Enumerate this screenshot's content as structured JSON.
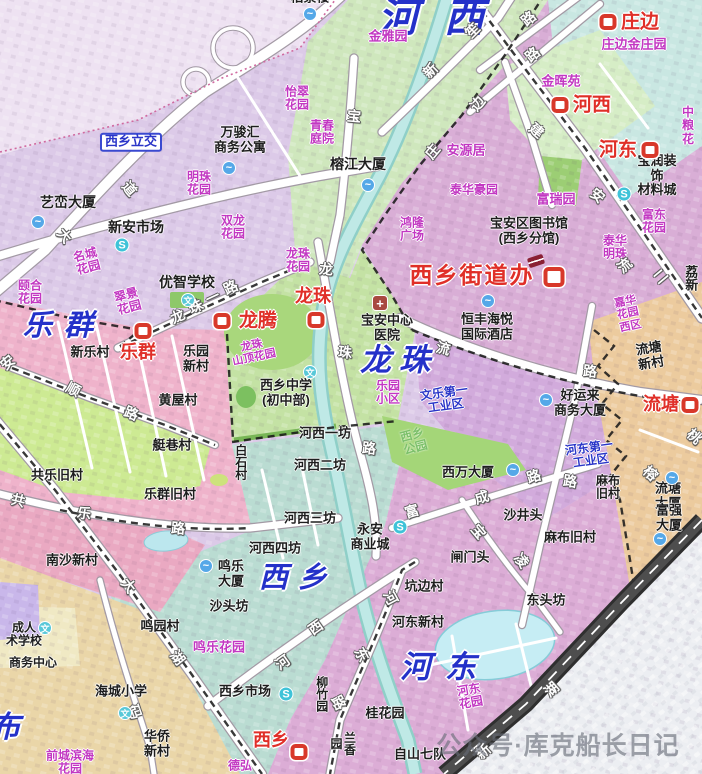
{
  "watermark": {
    "text": "公众号·库克船长日记"
  },
  "colors": {
    "district_label_blue": "#2431c9",
    "station_red": "#d8382a",
    "garden_magenta": "#c238c2",
    "industrial_blue": "#2a35c8",
    "river_teal": "#bfe9e6",
    "region_lavender": "#dccae8",
    "region_green_hexi": "#cfe7bd",
    "region_plum_hedong": "#d9aed6",
    "region_cyan_zhuangbian": "#c9e7e2",
    "region_pink_lequn": "#efb3cb",
    "region_green_longzhu": "#c4e2a4",
    "region_teal_xixiang": "#badcd2",
    "region_orchid_hedong_s": "#dcadd6",
    "region_tan_liutang": "#eccb9e",
    "highway_dark": "#2f2f2f"
  },
  "icon_glyphs": {
    "station": "",
    "water": "~",
    "market": "S",
    "school": "文",
    "hospital": "+",
    "book": ""
  },
  "labels": [
    {
      "t": "河西",
      "x": 444,
      "y": 19,
      "cls": "dist",
      "fs": 40,
      "ls": 26,
      "n": "district-hexi"
    },
    {
      "t": "乐群",
      "x": 64,
      "y": 326,
      "cls": "dist",
      "fs": 29,
      "ls": 12,
      "n": "district-lequn"
    },
    {
      "t": "龙珠",
      "x": 399,
      "y": 361,
      "cls": "dist",
      "fs": 31,
      "ls": 8,
      "n": "district-longzhu"
    },
    {
      "t": "西乡",
      "x": 298,
      "y": 578,
      "cls": "dist",
      "fs": 29,
      "ls": 10,
      "n": "district-xixiang"
    },
    {
      "t": "河东",
      "x": 445,
      "y": 668,
      "cls": "dist",
      "fs": 31,
      "ls": 14,
      "n": "district-hedong"
    },
    {
      "t": "布",
      "x": 5,
      "y": 728,
      "cls": "dist",
      "fs": 30,
      "n": "district-bu-partial"
    },
    {
      "t": "西乡街道办",
      "x": 472,
      "y": 276,
      "cls": "red",
      "fs": 23,
      "ls": 2,
      "n": "label-xixiang-jiedaoban"
    },
    {
      "t": "庄边",
      "x": 640,
      "y": 22,
      "cls": "red",
      "fs": 19
    },
    {
      "t": "河西",
      "x": 592,
      "y": 105,
      "cls": "red",
      "fs": 19
    },
    {
      "t": "河东",
      "x": 618,
      "y": 150,
      "cls": "red",
      "fs": 19
    },
    {
      "t": "龙腾",
      "x": 258,
      "y": 321,
      "cls": "red",
      "fs": 19
    },
    {
      "t": "乐群",
      "x": 138,
      "y": 352,
      "cls": "red"
    },
    {
      "t": "龙珠",
      "x": 313,
      "y": 296,
      "cls": "red"
    },
    {
      "t": "流塘",
      "x": 661,
      "y": 404,
      "cls": "red"
    },
    {
      "t": "西乡",
      "x": 271,
      "y": 740,
      "cls": "red"
    },
    {
      "t": "西乡立交",
      "x": 131,
      "y": 142,
      "cls": "box",
      "n": "label-xixiang-interchange"
    },
    {
      "t": "怡翠\n花园",
      "x": 297,
      "y": 99,
      "cls": "mag"
    },
    {
      "t": "青春\n庭院",
      "x": 322,
      "y": 133,
      "cls": "mag"
    },
    {
      "t": "金雅园",
      "x": 388,
      "y": 37,
      "cls": "mag",
      "fs": 13
    },
    {
      "t": "明珠\n花园",
      "x": 199,
      "y": 184,
      "cls": "mag"
    },
    {
      "t": "双龙\n花园",
      "x": 233,
      "y": 228,
      "cls": "mag"
    },
    {
      "t": "名城\n花园",
      "x": 87,
      "y": 262,
      "cls": "mag",
      "rot": -15
    },
    {
      "t": "翠景\n花园",
      "x": 128,
      "y": 302,
      "cls": "mag",
      "rot": -15
    },
    {
      "t": "颐合\n花园",
      "x": 30,
      "y": 293,
      "cls": "mag"
    },
    {
      "t": "庄边金庄园",
      "x": 634,
      "y": 45,
      "cls": "mag",
      "fs": 13
    },
    {
      "t": "金晖苑",
      "x": 561,
      "y": 82,
      "cls": "mag",
      "fs": 13
    },
    {
      "t": "安源居",
      "x": 466,
      "y": 151,
      "cls": "mag",
      "fs": 13
    },
    {
      "t": "泰华豪园",
      "x": 474,
      "y": 190,
      "cls": "mag"
    },
    {
      "t": "富瑞园",
      "x": 556,
      "y": 200,
      "cls": "mag",
      "fs": 13
    },
    {
      "t": "富东\n花园",
      "x": 654,
      "y": 222,
      "cls": "mag"
    },
    {
      "t": "泰华\n明珠",
      "x": 615,
      "y": 248,
      "cls": "mag"
    },
    {
      "t": "鸿隆\n广场",
      "x": 412,
      "y": 230,
      "cls": "mag"
    },
    {
      "t": "龙珠\n花园",
      "x": 298,
      "y": 261,
      "cls": "mag"
    },
    {
      "t": "龙珠\n山顶花园",
      "x": 253,
      "y": 352,
      "cls": "mag",
      "rot": -12,
      "fs": 11
    },
    {
      "t": "乐园\n小区",
      "x": 388,
      "y": 393,
      "cls": "mag"
    },
    {
      "t": "嘉华\n花园\n西区",
      "x": 628,
      "y": 314,
      "cls": "mag",
      "rot": -12,
      "fs": 11
    },
    {
      "t": "河东\n花园",
      "x": 470,
      "y": 697,
      "cls": "mag",
      "rot": -10
    },
    {
      "t": "鸣乐花园",
      "x": 219,
      "y": 648,
      "cls": "mag",
      "fs": 13
    },
    {
      "t": "前城滨海\n花园",
      "x": 70,
      "y": 763,
      "cls": "mag"
    },
    {
      "t": "德弘",
      "x": 240,
      "y": 766,
      "cls": "mag"
    },
    {
      "t": "中粮\n花",
      "x": 688,
      "y": 126,
      "cls": "mag"
    },
    {
      "t": "文乐第一\n工业区",
      "x": 445,
      "y": 400,
      "cls": "blu",
      "rot": -8
    },
    {
      "t": "河东第一\n工业区",
      "x": 590,
      "y": 455,
      "cls": "blu",
      "rot": -8
    },
    {
      "t": "西乡\n公园",
      "x": 414,
      "y": 442,
      "cls": "grn",
      "rot": -15
    },
    {
      "t": "柏景楼",
      "x": 310,
      "y": -2,
      "cls": "blk"
    },
    {
      "t": "万骏汇\n商务公寓",
      "x": 240,
      "y": 140,
      "cls": "blk"
    },
    {
      "t": "艺峦大厦",
      "x": 68,
      "y": 203,
      "cls": "blk",
      "fs": 14
    },
    {
      "t": "新安市场",
      "x": 136,
      "y": 228,
      "cls": "blk",
      "fs": 14
    },
    {
      "t": "榕江大厦",
      "x": 358,
      "y": 165,
      "cls": "blk",
      "fs": 14
    },
    {
      "t": "优智学校",
      "x": 187,
      "y": 283,
      "cls": "blk",
      "fs": 14
    },
    {
      "t": "宝安区图书馆\n(西乡分馆)",
      "x": 529,
      "y": 231,
      "cls": "blk"
    },
    {
      "t": "宝润装饰\n材料城",
      "x": 657,
      "y": 176,
      "cls": "blk"
    },
    {
      "t": "恒丰海悦\n国际酒店",
      "x": 487,
      "y": 327,
      "cls": "blk"
    },
    {
      "t": "宝安中心\n医院",
      "x": 387,
      "y": 328,
      "cls": "blk"
    },
    {
      "t": "西乡中学\n(初中部)",
      "x": 286,
      "y": 393,
      "cls": "blk"
    },
    {
      "t": "新乐村",
      "x": 90,
      "y": 353,
      "cls": "blk"
    },
    {
      "t": "乐园\n新村",
      "x": 196,
      "y": 359,
      "cls": "blk"
    },
    {
      "t": "黄屋村",
      "x": 178,
      "y": 401,
      "cls": "blk"
    },
    {
      "t": "艇巷村",
      "x": 172,
      "y": 446,
      "cls": "blk"
    },
    {
      "t": "乐群旧村",
      "x": 170,
      "y": 495,
      "cls": "blk"
    },
    {
      "t": "共乐旧村",
      "x": 57,
      "y": 476,
      "cls": "blk"
    },
    {
      "t": "南沙新村",
      "x": 72,
      "y": 561,
      "cls": "blk"
    },
    {
      "t": "白石村",
      "x": 240,
      "y": 462,
      "cls": "blk",
      "vert": true,
      "fs": 12
    },
    {
      "t": "河西一坊",
      "x": 325,
      "y": 434,
      "cls": "blk"
    },
    {
      "t": "河西二坊",
      "x": 320,
      "y": 466,
      "cls": "blk"
    },
    {
      "t": "河西三坊",
      "x": 310,
      "y": 519,
      "cls": "blk"
    },
    {
      "t": "河西四坊",
      "x": 275,
      "y": 549,
      "cls": "blk"
    },
    {
      "t": "永安\n商业城",
      "x": 370,
      "y": 537,
      "cls": "blk"
    },
    {
      "t": "鸣乐\n大厦",
      "x": 231,
      "y": 574,
      "cls": "blk"
    },
    {
      "t": "沙头坊",
      "x": 229,
      "y": 607,
      "cls": "blk"
    },
    {
      "t": "鸣园村",
      "x": 160,
      "y": 627,
      "cls": "blk"
    },
    {
      "t": "西乡市场",
      "x": 245,
      "y": 692,
      "cls": "blk"
    },
    {
      "t": "柳竹园",
      "x": 321,
      "y": 694,
      "cls": "blk",
      "vert": true,
      "fs": 12
    },
    {
      "t": "兰香园",
      "x": 342,
      "y": 743,
      "cls": "blk",
      "vert": true,
      "fs": 12
    },
    {
      "t": "桂花园",
      "x": 385,
      "y": 714,
      "cls": "blk"
    },
    {
      "t": "自山七队",
      "x": 420,
      "y": 755,
      "cls": "blk"
    },
    {
      "t": "华侨\n新村",
      "x": 157,
      "y": 744,
      "cls": "blk"
    },
    {
      "t": "海城小学",
      "x": 121,
      "y": 692,
      "cls": "blk"
    },
    {
      "t": "商务中心",
      "x": 33,
      "y": 663,
      "cls": "blk",
      "fs": 12
    },
    {
      "t": "成人\n术学校",
      "x": 24,
      "y": 635,
      "cls": "blk",
      "fs": 12
    },
    {
      "t": "西万大厦",
      "x": 468,
      "y": 473,
      "cls": "blk"
    },
    {
      "t": "沙井头",
      "x": 523,
      "y": 516,
      "cls": "blk"
    },
    {
      "t": "闸门头",
      "x": 470,
      "y": 558,
      "cls": "blk"
    },
    {
      "t": "坑边村",
      "x": 424,
      "y": 587,
      "cls": "blk"
    },
    {
      "t": "东头坊",
      "x": 546,
      "y": 601,
      "cls": "blk"
    },
    {
      "t": "河东新村",
      "x": 418,
      "y": 623,
      "cls": "blk"
    },
    {
      "t": "麻布\n旧村",
      "x": 608,
      "y": 488,
      "cls": "blk",
      "fs": 12
    },
    {
      "t": "麻布旧村",
      "x": 570,
      "y": 538,
      "cls": "blk"
    },
    {
      "t": "流塘大厦",
      "x": 668,
      "y": 496,
      "cls": "blk"
    },
    {
      "t": "富强大厦",
      "x": 669,
      "y": 518,
      "cls": "blk"
    },
    {
      "t": "流塘\n新村",
      "x": 650,
      "y": 356,
      "cls": "blk",
      "rot": -10
    },
    {
      "t": "好运来\n商务大厦",
      "x": 580,
      "y": 403,
      "cls": "blk"
    },
    {
      "t": "荔新",
      "x": 690,
      "y": 278,
      "cls": "blk",
      "vert": true
    },
    {
      "t": "大",
      "x": 64,
      "y": 236,
      "cls": "road",
      "rot": 50
    },
    {
      "t": "道",
      "x": 129,
      "y": 189,
      "cls": "road",
      "rot": 50
    },
    {
      "t": "新",
      "x": 431,
      "y": 71,
      "cls": "road",
      "rot": -45
    },
    {
      "t": "笙",
      "x": 473,
      "y": 31,
      "cls": "road",
      "rot": -45
    },
    {
      "t": "路",
      "x": 529,
      "y": 19,
      "cls": "road",
      "rot": -40
    },
    {
      "t": "路",
      "x": 533,
      "y": 55,
      "cls": "road",
      "rot": -40
    },
    {
      "t": "宝",
      "x": 354,
      "y": 117,
      "cls": "road",
      "rot": 5
    },
    {
      "t": "庄",
      "x": 433,
      "y": 152,
      "cls": "road",
      "rot": -50
    },
    {
      "t": "边",
      "x": 478,
      "y": 104,
      "cls": "road",
      "rot": -50
    },
    {
      "t": "建",
      "x": 536,
      "y": 131,
      "cls": "road",
      "rot": 40
    },
    {
      "t": "安",
      "x": 597,
      "y": 196,
      "cls": "road",
      "rot": 40
    },
    {
      "t": "流",
      "x": 443,
      "y": 349,
      "cls": "road",
      "rot": 15
    },
    {
      "t": "路",
      "x": 590,
      "y": 372,
      "cls": "road",
      "rot": 5
    },
    {
      "t": "路",
      "x": 570,
      "y": 482,
      "cls": "road",
      "rot": 8
    },
    {
      "t": "流",
      "x": 625,
      "y": 266,
      "cls": "road",
      "rot": -40
    },
    {
      "t": "二",
      "x": 661,
      "y": 277,
      "cls": "road",
      "rot": -40
    },
    {
      "t": "榕",
      "x": 650,
      "y": 474,
      "cls": "road",
      "rot": 42
    },
    {
      "t": "桃",
      "x": 694,
      "y": 437,
      "cls": "road",
      "rot": 42
    },
    {
      "t": "龙",
      "x": 326,
      "y": 270,
      "cls": "road",
      "rot": 5
    },
    {
      "t": "珠",
      "x": 345,
      "y": 353,
      "cls": "road",
      "rot": 5
    },
    {
      "t": "路",
      "x": 369,
      "y": 449,
      "cls": "road",
      "rot": 5
    },
    {
      "t": "龙",
      "x": 178,
      "y": 317,
      "cls": "road",
      "rot": -25
    },
    {
      "t": "珠",
      "x": 196,
      "y": 307,
      "cls": "road",
      "rot": -25
    },
    {
      "t": "一",
      "x": 213,
      "y": 298,
      "cls": "road",
      "rot": -25
    },
    {
      "t": "路",
      "x": 231,
      "y": 288,
      "cls": "road",
      "rot": -25
    },
    {
      "t": "顺",
      "x": 73,
      "y": 390,
      "cls": "road",
      "rot": 28
    },
    {
      "t": "路",
      "x": 131,
      "y": 414,
      "cls": "road",
      "rot": 22
    },
    {
      "t": "共",
      "x": 18,
      "y": 501,
      "cls": "road",
      "rot": 14
    },
    {
      "t": "乐",
      "x": 84,
      "y": 514,
      "cls": "road",
      "rot": 8
    },
    {
      "t": "路",
      "x": 178,
      "y": 529,
      "cls": "road",
      "rot": 4
    },
    {
      "t": "河",
      "x": 283,
      "y": 663,
      "cls": "road",
      "rot": -35
    },
    {
      "t": "西",
      "x": 316,
      "y": 628,
      "cls": "road",
      "rot": -35
    },
    {
      "t": "河",
      "x": 390,
      "y": 598,
      "cls": "road",
      "rot": 62
    },
    {
      "t": "东",
      "x": 361,
      "y": 655,
      "cls": "road",
      "rot": 62
    },
    {
      "t": "路",
      "x": 338,
      "y": 703,
      "cls": "road",
      "rot": 62
    },
    {
      "t": "码",
      "x": 134,
      "y": 712,
      "cls": "road",
      "rot": 70
    },
    {
      "t": "大",
      "x": 128,
      "y": 586,
      "cls": "road",
      "rot": 52
    },
    {
      "t": "湖",
      "x": 177,
      "y": 658,
      "cls": "road",
      "rot": 52
    },
    {
      "t": "富",
      "x": 412,
      "y": 512,
      "cls": "road",
      "rot": -17
    },
    {
      "t": "成",
      "x": 482,
      "y": 498,
      "cls": "road",
      "rot": -17
    },
    {
      "t": "路",
      "x": 534,
      "y": 477,
      "cls": "road",
      "rot": -17
    },
    {
      "t": "宝",
      "x": 478,
      "y": 532,
      "cls": "road",
      "rot": 50
    },
    {
      "t": "凌",
      "x": 521,
      "y": 561,
      "cls": "road",
      "rot": 50
    },
    {
      "t": "新",
      "x": 484,
      "y": 752,
      "cls": "road",
      "rot": -42
    },
    {
      "t": "湖",
      "x": 552,
      "y": 690,
      "cls": "road",
      "rot": -42
    },
    {
      "t": "安",
      "x": 8,
      "y": 363,
      "cls": "road",
      "rot": -40
    }
  ],
  "icons": [
    {
      "type": "station",
      "x": 608,
      "y": 22
    },
    {
      "type": "station",
      "x": 560,
      "y": 105
    },
    {
      "type": "station",
      "x": 650,
      "y": 150
    },
    {
      "type": "station",
      "x": 222,
      "y": 321
    },
    {
      "type": "station",
      "x": 143,
      "y": 331
    },
    {
      "type": "station",
      "x": 316,
      "y": 320
    },
    {
      "type": "station",
      "x": 690,
      "y": 405
    },
    {
      "type": "station",
      "x": 299,
      "y": 752
    },
    {
      "type": "station",
      "x": 554,
      "y": 277,
      "s": 21
    },
    {
      "type": "water",
      "x": 310,
      "y": 14
    },
    {
      "type": "water",
      "x": 38,
      "y": 222
    },
    {
      "type": "water",
      "x": 229,
      "y": 168
    },
    {
      "type": "water",
      "x": 368,
      "y": 185
    },
    {
      "type": "water",
      "x": 488,
      "y": 301
    },
    {
      "type": "water",
      "x": 206,
      "y": 566
    },
    {
      "type": "water",
      "x": 513,
      "y": 470
    },
    {
      "type": "water",
      "x": 672,
      "y": 478
    },
    {
      "type": "water",
      "x": 660,
      "y": 539
    },
    {
      "type": "water",
      "x": 546,
      "y": 400
    },
    {
      "type": "market",
      "x": 122,
      "y": 245
    },
    {
      "type": "market",
      "x": 624,
      "y": 194
    },
    {
      "type": "market",
      "x": 400,
      "y": 527
    },
    {
      "type": "market",
      "x": 286,
      "y": 694
    },
    {
      "type": "school",
      "x": 188,
      "y": 300
    },
    {
      "type": "school",
      "x": 310,
      "y": 372
    },
    {
      "type": "school",
      "x": 125,
      "y": 713
    },
    {
      "type": "school",
      "x": 45,
      "y": 628
    },
    {
      "type": "hospital",
      "x": 380,
      "y": 303
    },
    {
      "type": "book",
      "x": 536,
      "y": 261
    }
  ]
}
